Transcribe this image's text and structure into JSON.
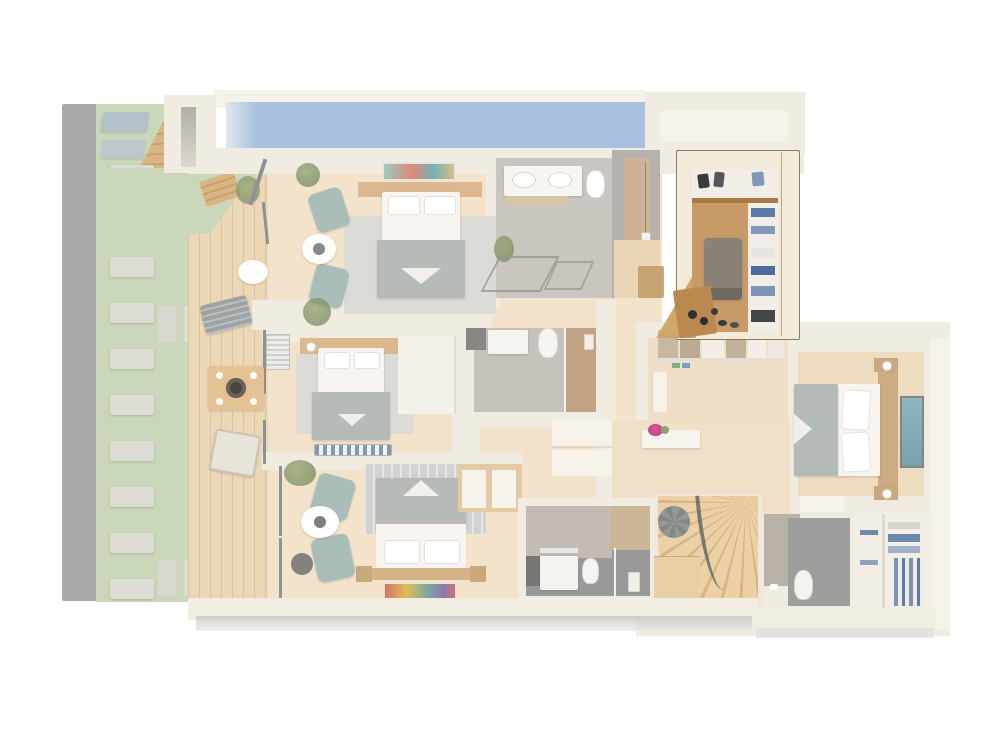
{
  "scene": {
    "type": "3d-floor-plan-render",
    "view": "top-down isometric",
    "highlighted_room": "walk-in-closet",
    "faded_background": true
  },
  "colors": {
    "canvas": "#ffffff",
    "wall": "#f1ece1",
    "wallLight": "#f6f2ea",
    "wallRight": "#f0ebe2",
    "pool": "#a9c1de",
    "lawn": "#cbd7ba",
    "stone": "#a7a9ab",
    "slab": "#dcdbd4",
    "padBlue": "#b3c2ca",
    "deck": "#ecd7b6",
    "wood": "#f2e3ca",
    "woodDark": "#eedcc0",
    "hallWood": "#f0e0c8",
    "stepWood": "#d9b583",
    "stepWoodDark": "#c7a26e",
    "rug": "#dcdbd7",
    "teal": "#a9bdb9",
    "bedWhite": "#f8f5f0",
    "pillow": "#ffffff",
    "blanket": "#b7bbb7",
    "woodFurn": "#dcb88e",
    "frameDark": "#8f9294",
    "marble": "#cbc5bf",
    "tile": "#c8c2bc",
    "darkTile": "#98999a",
    "showerTan": "#cdb294",
    "grayWall": "#b5b1ad",
    "plant": "#8fa16f",
    "plantDark": "#6f835a",
    "pink": "#e0569a",
    "artTeal": "#76aebe",
    "stripeBlue": "#7f9ab8",
    "planter": "#9aa0a0",
    "shadow": "#bdbdbb",
    "closetWall": "#f2ebd9",
    "closetBorder": "#8d7a64",
    "closetFloor": "#c79a67",
    "closetShelf": "#f2eee7",
    "closetBench": "#8b8277",
    "closetBenchDark": "#6e685e",
    "closetCounter": "#b9894f",
    "closetWedge": "#cfa76c",
    "closetBlue1": "#5e7ca8",
    "closetBlue2": "#8298ba",
    "closetDark": "#3a3a3c",
    "rugRed": "#c95a4e",
    "rugYellow": "#e0b23e",
    "rugTeal": "#5f9d92",
    "rugPurple": "#7a5ba8"
  }
}
